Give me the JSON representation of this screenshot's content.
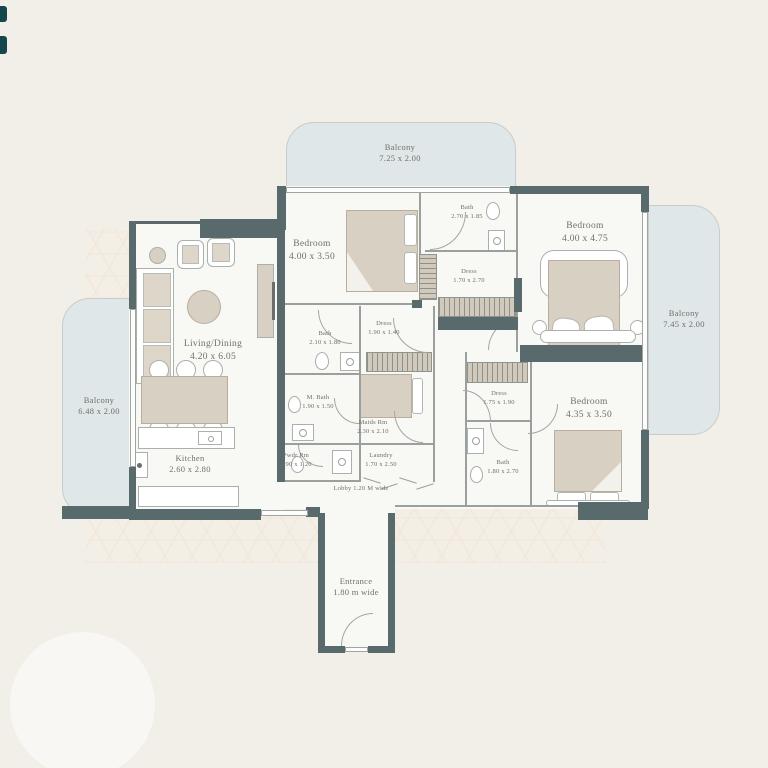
{
  "plan": {
    "title": "Apartment floor plan",
    "balconies": [
      {
        "name": "Balcony",
        "dims": "7.25 x 2.00",
        "position": "top"
      },
      {
        "name": "Balcony",
        "dims": "7.45 x 2.00",
        "position": "right"
      },
      {
        "name": "Balcony",
        "dims": "6.48 x 2.00",
        "position": "left"
      }
    ],
    "rooms": [
      {
        "name": "Living/Dining",
        "dims": "4.20 x 6.05"
      },
      {
        "name": "Kitchen",
        "dims": "2.60 x 2.80"
      },
      {
        "name": "Bedroom",
        "dims": "4.00 x 3.50"
      },
      {
        "name": "Bath",
        "dims": "2.70 x 1.85"
      },
      {
        "name": "Dress",
        "dims": "1.70 x 2.70"
      },
      {
        "name": "Bedroom",
        "dims": "4.00 x 4.75"
      },
      {
        "name": "Bath",
        "dims": "2.10 x 1.80"
      },
      {
        "name": "Dress",
        "dims": "1.90 x 1.40"
      },
      {
        "name": "M. Bath",
        "dims": "1.90 x 1.50"
      },
      {
        "name": "Maids Rm",
        "dims": "2.30 x 2.10"
      },
      {
        "name": "Pwdr Rm",
        "dims": "1.90 x 1.20"
      },
      {
        "name": "Laundry",
        "dims": "1.70 x 2.50"
      },
      {
        "name": "Dress",
        "dims": "1.75 x 1.90"
      },
      {
        "name": "Bath",
        "dims": "1.80 x 2.70"
      },
      {
        "name": "Bedroom",
        "dims": "4.35 x 3.50"
      }
    ],
    "annotations": {
      "lobby": "Lobby 1.20 M wide",
      "entrance": {
        "name": "Entrance",
        "dims": "1.80 m wide"
      }
    },
    "colors": {
      "background": "#f2efe8",
      "wall": "#596a6c",
      "floor": "#f8f8f5",
      "balcony_fill": "#dfe7e9",
      "furniture_beige": "#d8d0c3",
      "label_text": "#6e706b",
      "logo_teal": "#15464c"
    }
  }
}
